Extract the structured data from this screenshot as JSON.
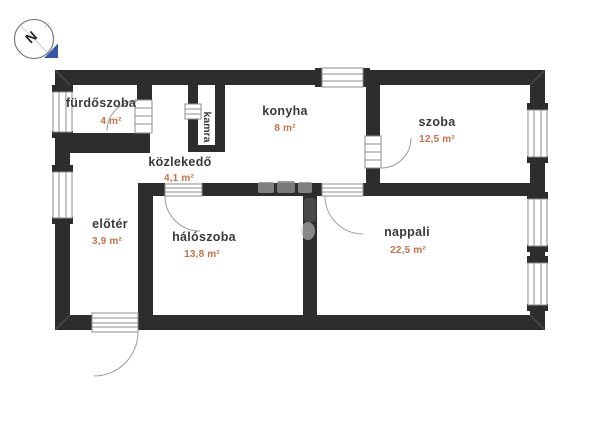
{
  "plan": {
    "type": "floor-plan",
    "language": "hu",
    "background_color": "#ffffff",
    "wall_color": "#2d2d2d",
    "room_label_color": "#3a3a3a",
    "area_label_color": "#c1734d",
    "rooms": [
      {
        "id": "furdoszoba",
        "label": "fürdőszoba",
        "area": "4 m²"
      },
      {
        "id": "konyha",
        "label": "konyha",
        "area": "8 m²"
      },
      {
        "id": "szoba",
        "label": "szoba",
        "area": "12,5 m²"
      },
      {
        "id": "kozlekedo",
        "label": "közlekedő",
        "area": "4,1 m²"
      },
      {
        "id": "kamra",
        "label": "kamra",
        "area": ""
      },
      {
        "id": "haloszoba",
        "label": "hálószoba",
        "area": "13,8 m²"
      },
      {
        "id": "nappali",
        "label": "nappali",
        "area": "22,5 m²"
      },
      {
        "id": "eloter",
        "label": "előtér",
        "area": "3,9 m²"
      }
    ],
    "compass": {
      "letter": "N",
      "triangle_color": "#3a57a5"
    }
  }
}
